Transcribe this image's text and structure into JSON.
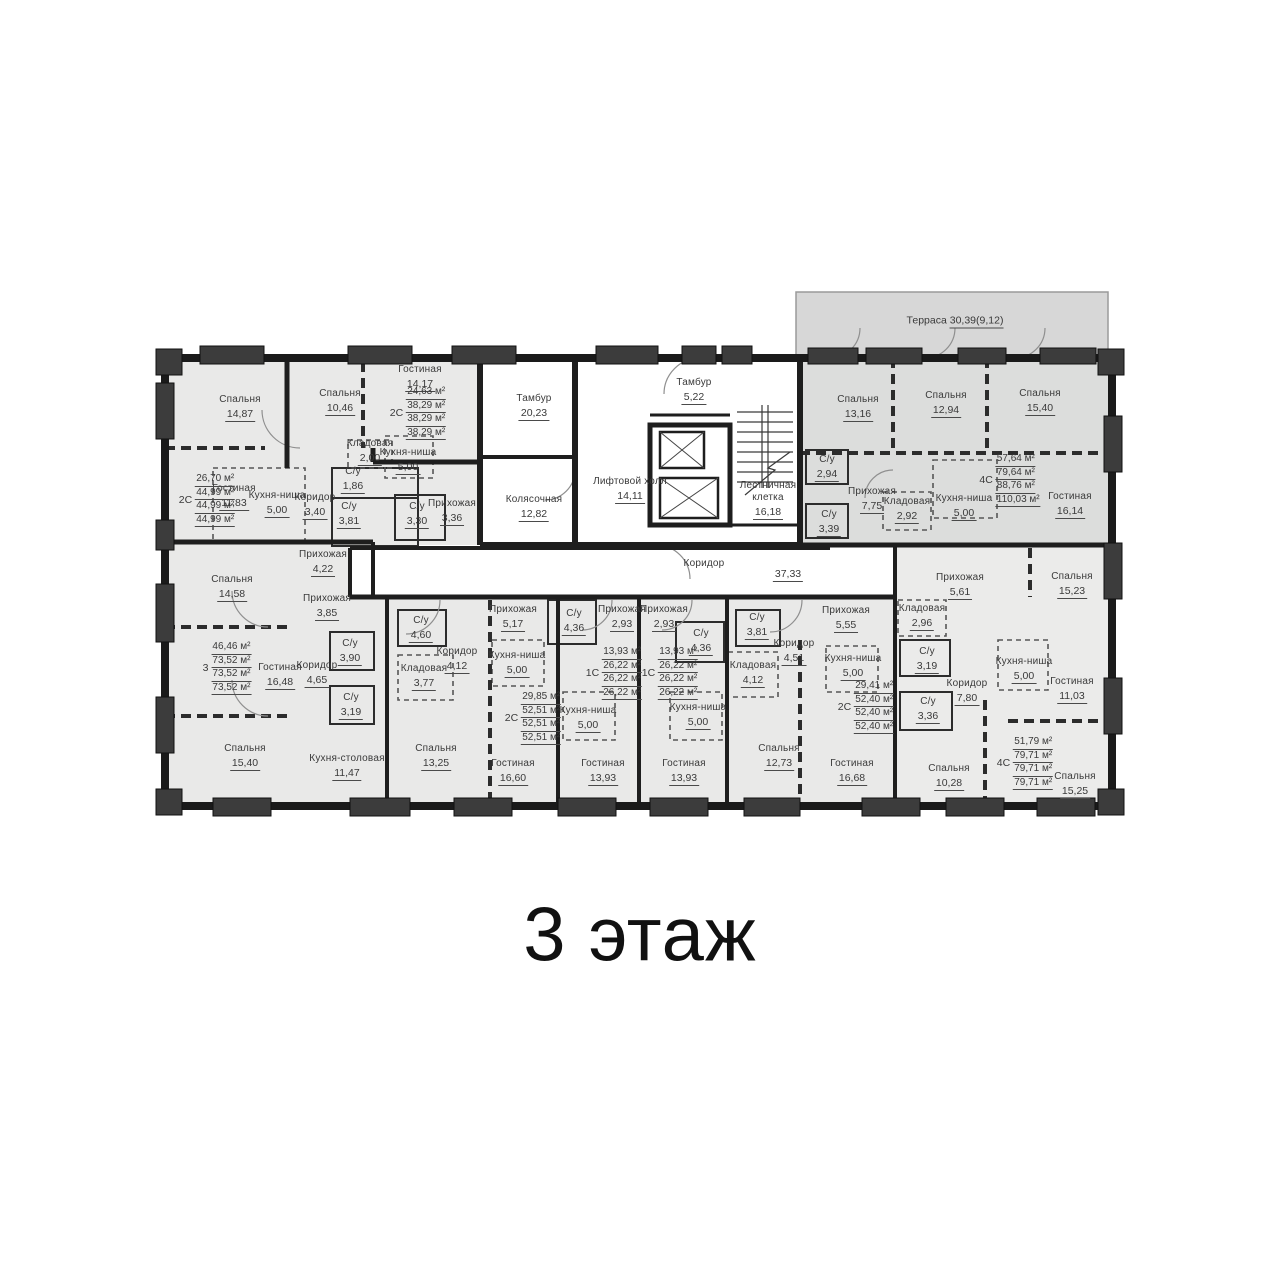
{
  "title": "3 этаж",
  "terrace": {
    "label": "Терраса",
    "value": "30,39(9,12)"
  },
  "rooms": [
    {
      "label": "Спальня",
      "value": "14,87",
      "x": 240,
      "y": 408
    },
    {
      "label": "Гостиная",
      "value": "11,83",
      "x": 234,
      "y": 497
    },
    {
      "label": "Кухня-ниша",
      "value": "5,00",
      "x": 277,
      "y": 504
    },
    {
      "label": "Коридор",
      "value": "3,40",
      "x": 315,
      "y": 506
    },
    {
      "label": "С/у",
      "value": "1,86",
      "x": 353,
      "y": 480
    },
    {
      "label": "С/у",
      "value": "3,81",
      "x": 349,
      "y": 515
    },
    {
      "label": "Прихожая",
      "value": "4,22",
      "x": 323,
      "y": 563
    },
    {
      "label": "Спальня",
      "value": "10,46",
      "x": 340,
      "y": 402
    },
    {
      "label": "Гостиная",
      "value": "14,17",
      "x": 420,
      "y": 378
    },
    {
      "label": "Кладовая",
      "value": "2,00",
      "x": 370,
      "y": 452
    },
    {
      "label": "Кухня-ниша",
      "value": "5,00",
      "x": 408,
      "y": 461
    },
    {
      "label": "С/у",
      "value": "3,30",
      "x": 417,
      "y": 515
    },
    {
      "label": "Прихожая",
      "value": "3,36",
      "x": 452,
      "y": 512
    },
    {
      "label": "Спальня",
      "value": "14,58",
      "x": 232,
      "y": 588
    },
    {
      "label": "Прихожая",
      "value": "3,85",
      "x": 327,
      "y": 607
    },
    {
      "label": "Гостиная",
      "value": "16,48",
      "x": 280,
      "y": 676
    },
    {
      "label": "Коридор",
      "value": "4,65",
      "x": 317,
      "y": 674
    },
    {
      "label": "С/у",
      "value": "3,90",
      "x": 350,
      "y": 652
    },
    {
      "label": "С/у",
      "value": "3,19",
      "x": 351,
      "y": 706
    },
    {
      "label": "Спальня",
      "value": "15,40",
      "x": 245,
      "y": 757
    },
    {
      "label": "Кухня-столовая",
      "value": "11,47",
      "x": 347,
      "y": 767
    },
    {
      "label": "С/у",
      "value": "4,60",
      "x": 421,
      "y": 629
    },
    {
      "label": "Кладовая",
      "value": "3,77",
      "x": 424,
      "y": 677
    },
    {
      "label": "Коридор",
      "value": "4,12",
      "x": 457,
      "y": 660
    },
    {
      "label": "Спальня",
      "value": "13,25",
      "x": 436,
      "y": 757
    },
    {
      "label": "Прихожая",
      "value": "5,17",
      "x": 513,
      "y": 618
    },
    {
      "label": "Кухня-ниша",
      "value": "5,00",
      "x": 517,
      "y": 664
    },
    {
      "label": "Гостиная",
      "value": "16,60",
      "x": 513,
      "y": 772
    },
    {
      "label": "С/у",
      "value": "4,36",
      "x": 574,
      "y": 622
    },
    {
      "label": "Прихожая",
      "value": "2,93",
      "x": 622,
      "y": 618
    },
    {
      "label": "Кухня-ниша",
      "value": "5,00",
      "x": 588,
      "y": 719
    },
    {
      "label": "Гостиная",
      "value": "13,93",
      "x": 603,
      "y": 772
    },
    {
      "label": "Прихожая",
      "value": "2,93",
      "x": 664,
      "y": 618
    },
    {
      "label": "С/у",
      "value": "4,36",
      "x": 701,
      "y": 642
    },
    {
      "label": "Кухня-ниша",
      "value": "5,00",
      "x": 698,
      "y": 716
    },
    {
      "label": "Гостиная",
      "value": "13,93",
      "x": 684,
      "y": 772
    },
    {
      "label": "С/у",
      "value": "3,81",
      "x": 757,
      "y": 626
    },
    {
      "label": "Коридор",
      "value": "4,51",
      "x": 794,
      "y": 652
    },
    {
      "label": "Кладовая",
      "value": "4,12",
      "x": 753,
      "y": 674
    },
    {
      "label": "Прихожая",
      "value": "5,55",
      "x": 846,
      "y": 619
    },
    {
      "label": "Кухня-ниша",
      "value": "5,00",
      "x": 853,
      "y": 667
    },
    {
      "label": "Спальня",
      "value": "12,73",
      "x": 779,
      "y": 757
    },
    {
      "label": "Гостиная",
      "value": "16,68",
      "x": 852,
      "y": 772
    },
    {
      "label": "Спальня",
      "value": "13,16",
      "x": 858,
      "y": 408
    },
    {
      "label": "Спальня",
      "value": "12,94",
      "x": 946,
      "y": 404
    },
    {
      "label": "Спальня",
      "value": "15,40",
      "x": 1040,
      "y": 402
    },
    {
      "label": "С/у",
      "value": "2,94",
      "x": 827,
      "y": 468
    },
    {
      "label": "Прихожая",
      "value": "7,75",
      "x": 872,
      "y": 500
    },
    {
      "label": "Кладовая",
      "value": "2,92",
      "x": 907,
      "y": 510
    },
    {
      "label": "С/у",
      "value": "3,39",
      "x": 829,
      "y": 523
    },
    {
      "label": "Кухня-ниша",
      "value": "5,00",
      "x": 964,
      "y": 507
    },
    {
      "label": "Гостиная",
      "value": "16,14",
      "x": 1070,
      "y": 505
    },
    {
      "label": "Прихожая",
      "value": "5,61",
      "x": 960,
      "y": 586
    },
    {
      "label": "Кладовая",
      "value": "2,96",
      "x": 922,
      "y": 617
    },
    {
      "label": "С/у",
      "value": "3,19",
      "x": 927,
      "y": 660
    },
    {
      "label": "Коридор",
      "value": "7,80",
      "x": 967,
      "y": 692
    },
    {
      "label": "С/у",
      "value": "3,36",
      "x": 928,
      "y": 710
    },
    {
      "label": "Спальня",
      "value": "15,23",
      "x": 1072,
      "y": 585
    },
    {
      "label": "Кухня-ниша",
      "value": "5,00",
      "x": 1024,
      "y": 670
    },
    {
      "label": "Гостиная",
      "value": "11,03",
      "x": 1072,
      "y": 690
    },
    {
      "label": "Спальня",
      "value": "10,28",
      "x": 949,
      "y": 777
    },
    {
      "label": "Спальня",
      "value": "15,25",
      "x": 1075,
      "y": 785
    },
    {
      "label": "Тамбур",
      "value": "20,23",
      "x": 534,
      "y": 407
    },
    {
      "label": "Колясочная",
      "value": "12,82",
      "x": 534,
      "y": 508
    },
    {
      "label": "Лифтовой холл",
      "value": "14,11",
      "x": 630,
      "y": 490
    },
    {
      "label": "Тамбур",
      "value": "5,22",
      "x": 694,
      "y": 391
    },
    {
      "label": "Лестничная клетка",
      "value": "16,18",
      "x": 768,
      "y": 500
    },
    {
      "label": "Коридор",
      "value": "",
      "x": 704,
      "y": 564
    },
    {
      "label": "",
      "value": "37,33",
      "x": 788,
      "y": 574
    }
  ],
  "stacks": [
    {
      "type": "2С",
      "lines": [
        "26,70 м²",
        "44,99 м²",
        "44,99 м²",
        "44,99 м²"
      ],
      "x": 207,
      "y": 500
    },
    {
      "type": "2С",
      "lines": [
        "24,63 м²",
        "38,29 м²",
        "38,29 м²",
        "38,29 м²"
      ],
      "x": 418,
      "y": 413
    },
    {
      "type": "3",
      "lines": [
        "46,46 м²",
        "73,52 м²",
        "73,52 м²",
        "73,52 м²"
      ],
      "x": 227,
      "y": 668
    },
    {
      "type": "2С",
      "lines": [
        "29,85 м²",
        "52,51 м²",
        "52,51 м²",
        "52,51 м²"
      ],
      "x": 533,
      "y": 718
    },
    {
      "type": "1С",
      "lines": [
        "13,93 м²",
        "26,22 м²",
        "26,22 м²",
        "26,22 м²"
      ],
      "x": 614,
      "y": 673
    },
    {
      "type": "1С",
      "lines": [
        "13,93 м²",
        "26,22 м²",
        "26,22 м²",
        "26,22 м²"
      ],
      "x": 670,
      "y": 673
    },
    {
      "type": "2С",
      "lines": [
        "29,41 м²",
        "52,40 м²",
        "52,40 м²",
        "52,40 м²"
      ],
      "x": 866,
      "y": 707
    },
    {
      "type": "4С",
      "lines": [
        "57,64 м²",
        "79,64 м²",
        "88,76 м²",
        "110,03 м²"
      ],
      "x": 1010,
      "y": 480
    },
    {
      "type": "4С",
      "lines": [
        "51,79 м²",
        "79,71 м²",
        "79,71 м²",
        "79,71 м²"
      ],
      "x": 1025,
      "y": 763
    }
  ]
}
